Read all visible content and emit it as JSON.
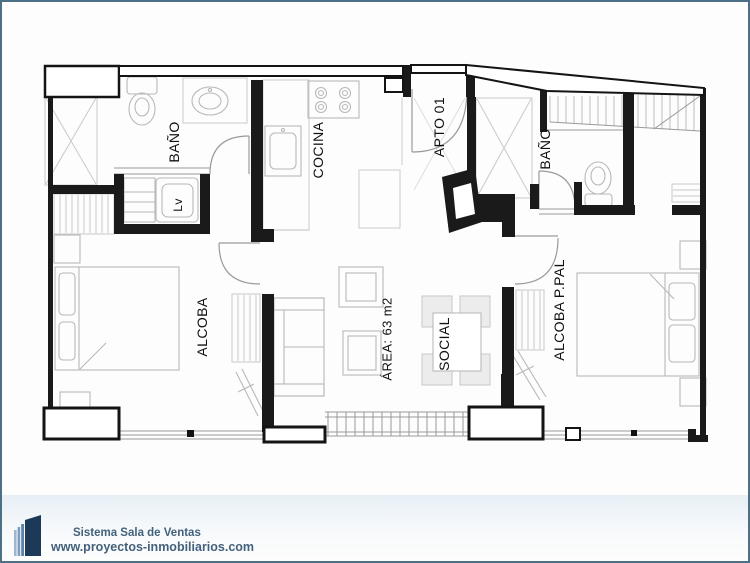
{
  "plan": {
    "room_labels": {
      "bano_left": "BAÑO",
      "lavadero": "Lv",
      "cocina": "COCINA",
      "apto": "APTO 01",
      "bano_right": "BAÑO",
      "alcoba": "ALCOBA",
      "area": "ÁREA: 63 m2",
      "social": "SOCIAL",
      "alcoba_ppal": "ALCOBA P.PAL"
    }
  },
  "footer": {
    "line1": "Sistema Sala de Ventas",
    "line2": "www.proyectos-inmobiliarios.com"
  },
  "colors": {
    "border": "#4c7086",
    "walls": "#1a1a1a",
    "furniture": "#b8b8b8",
    "window_lines": "#999999",
    "brand_text": "#44617c",
    "logo_dark": "#1c3a57",
    "logo_light": "#8aa9c6"
  }
}
